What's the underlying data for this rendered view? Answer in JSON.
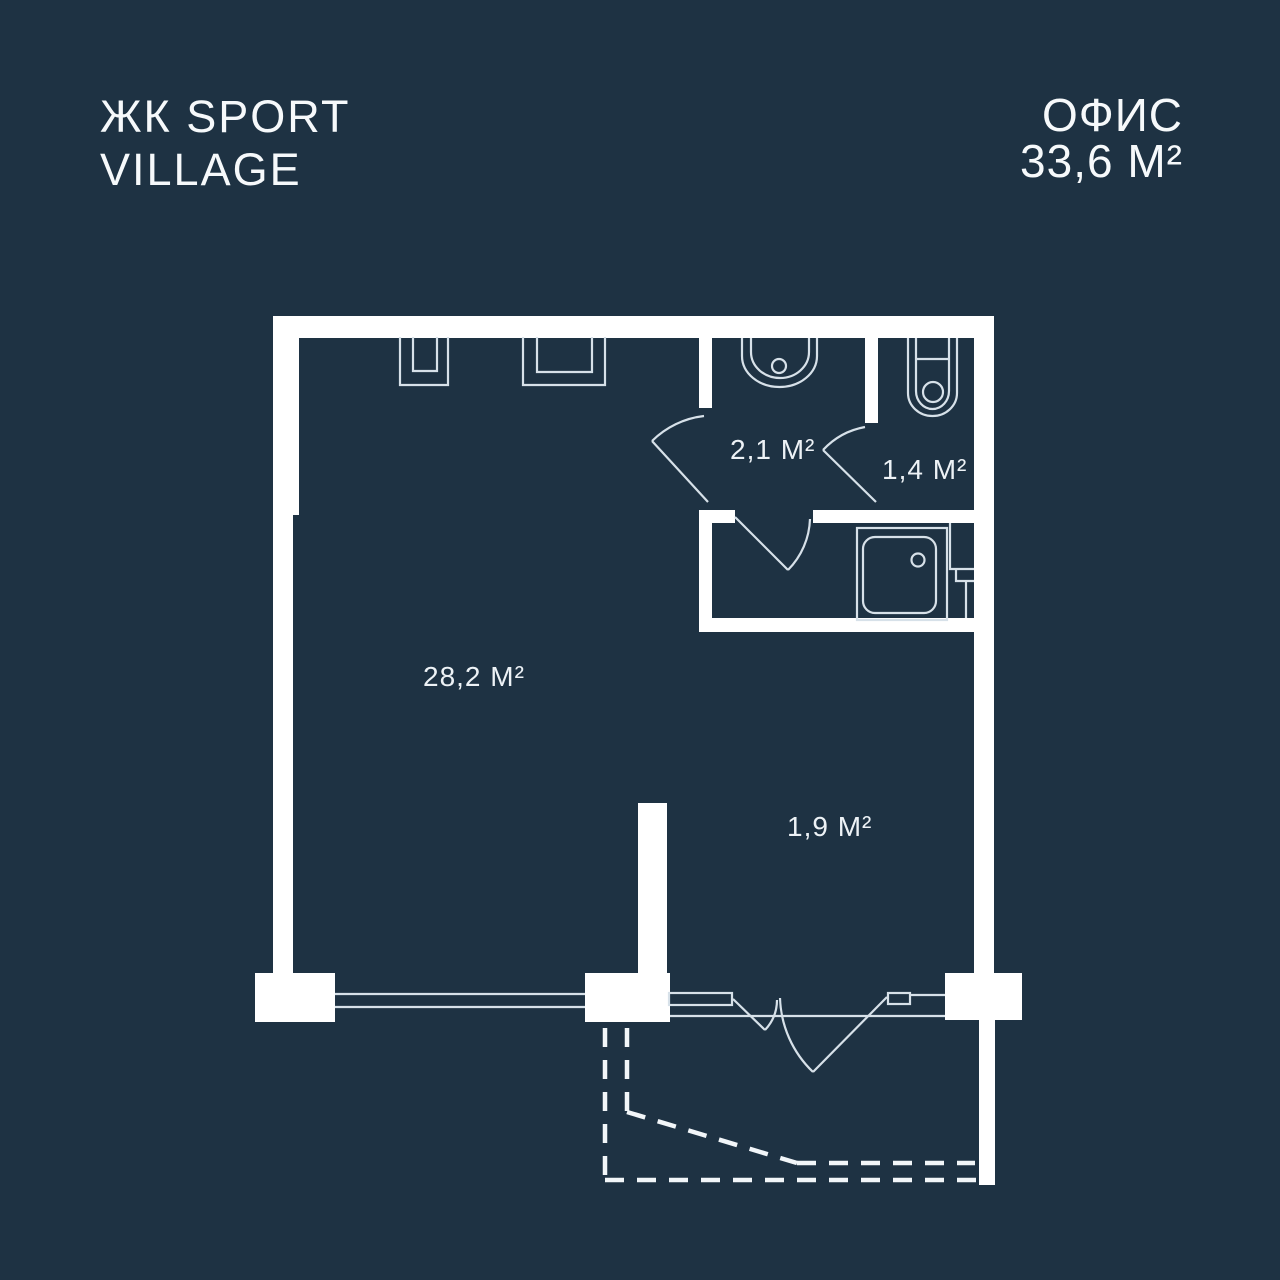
{
  "header": {
    "logo_line1": "ЖК SPORT",
    "logo_line2": "VILLAGE",
    "unit_type": "ОФИС",
    "unit_area": "33,6 М²"
  },
  "floorplan": {
    "rooms": [
      {
        "id": "main-room",
        "area_label": "28,2 М²"
      },
      {
        "id": "hallway",
        "area_label": "2,1 М²"
      },
      {
        "id": "wc",
        "area_label": "1,4 М²"
      },
      {
        "id": "entry-niche",
        "area_label": "1,9 М²"
      }
    ],
    "fixtures": [
      "washbasin-icon",
      "toilet-icon",
      "shower-tray-icon",
      "ventilation-niche-small-icon",
      "ventilation-niche-large-icon",
      "corner-duct-icon",
      "balcony-dashed-outline"
    ],
    "colors": {
      "background": "#1e3243",
      "walls": "#ffffff",
      "lines": "#d7e1e9",
      "text": "#f2f6f9"
    }
  }
}
